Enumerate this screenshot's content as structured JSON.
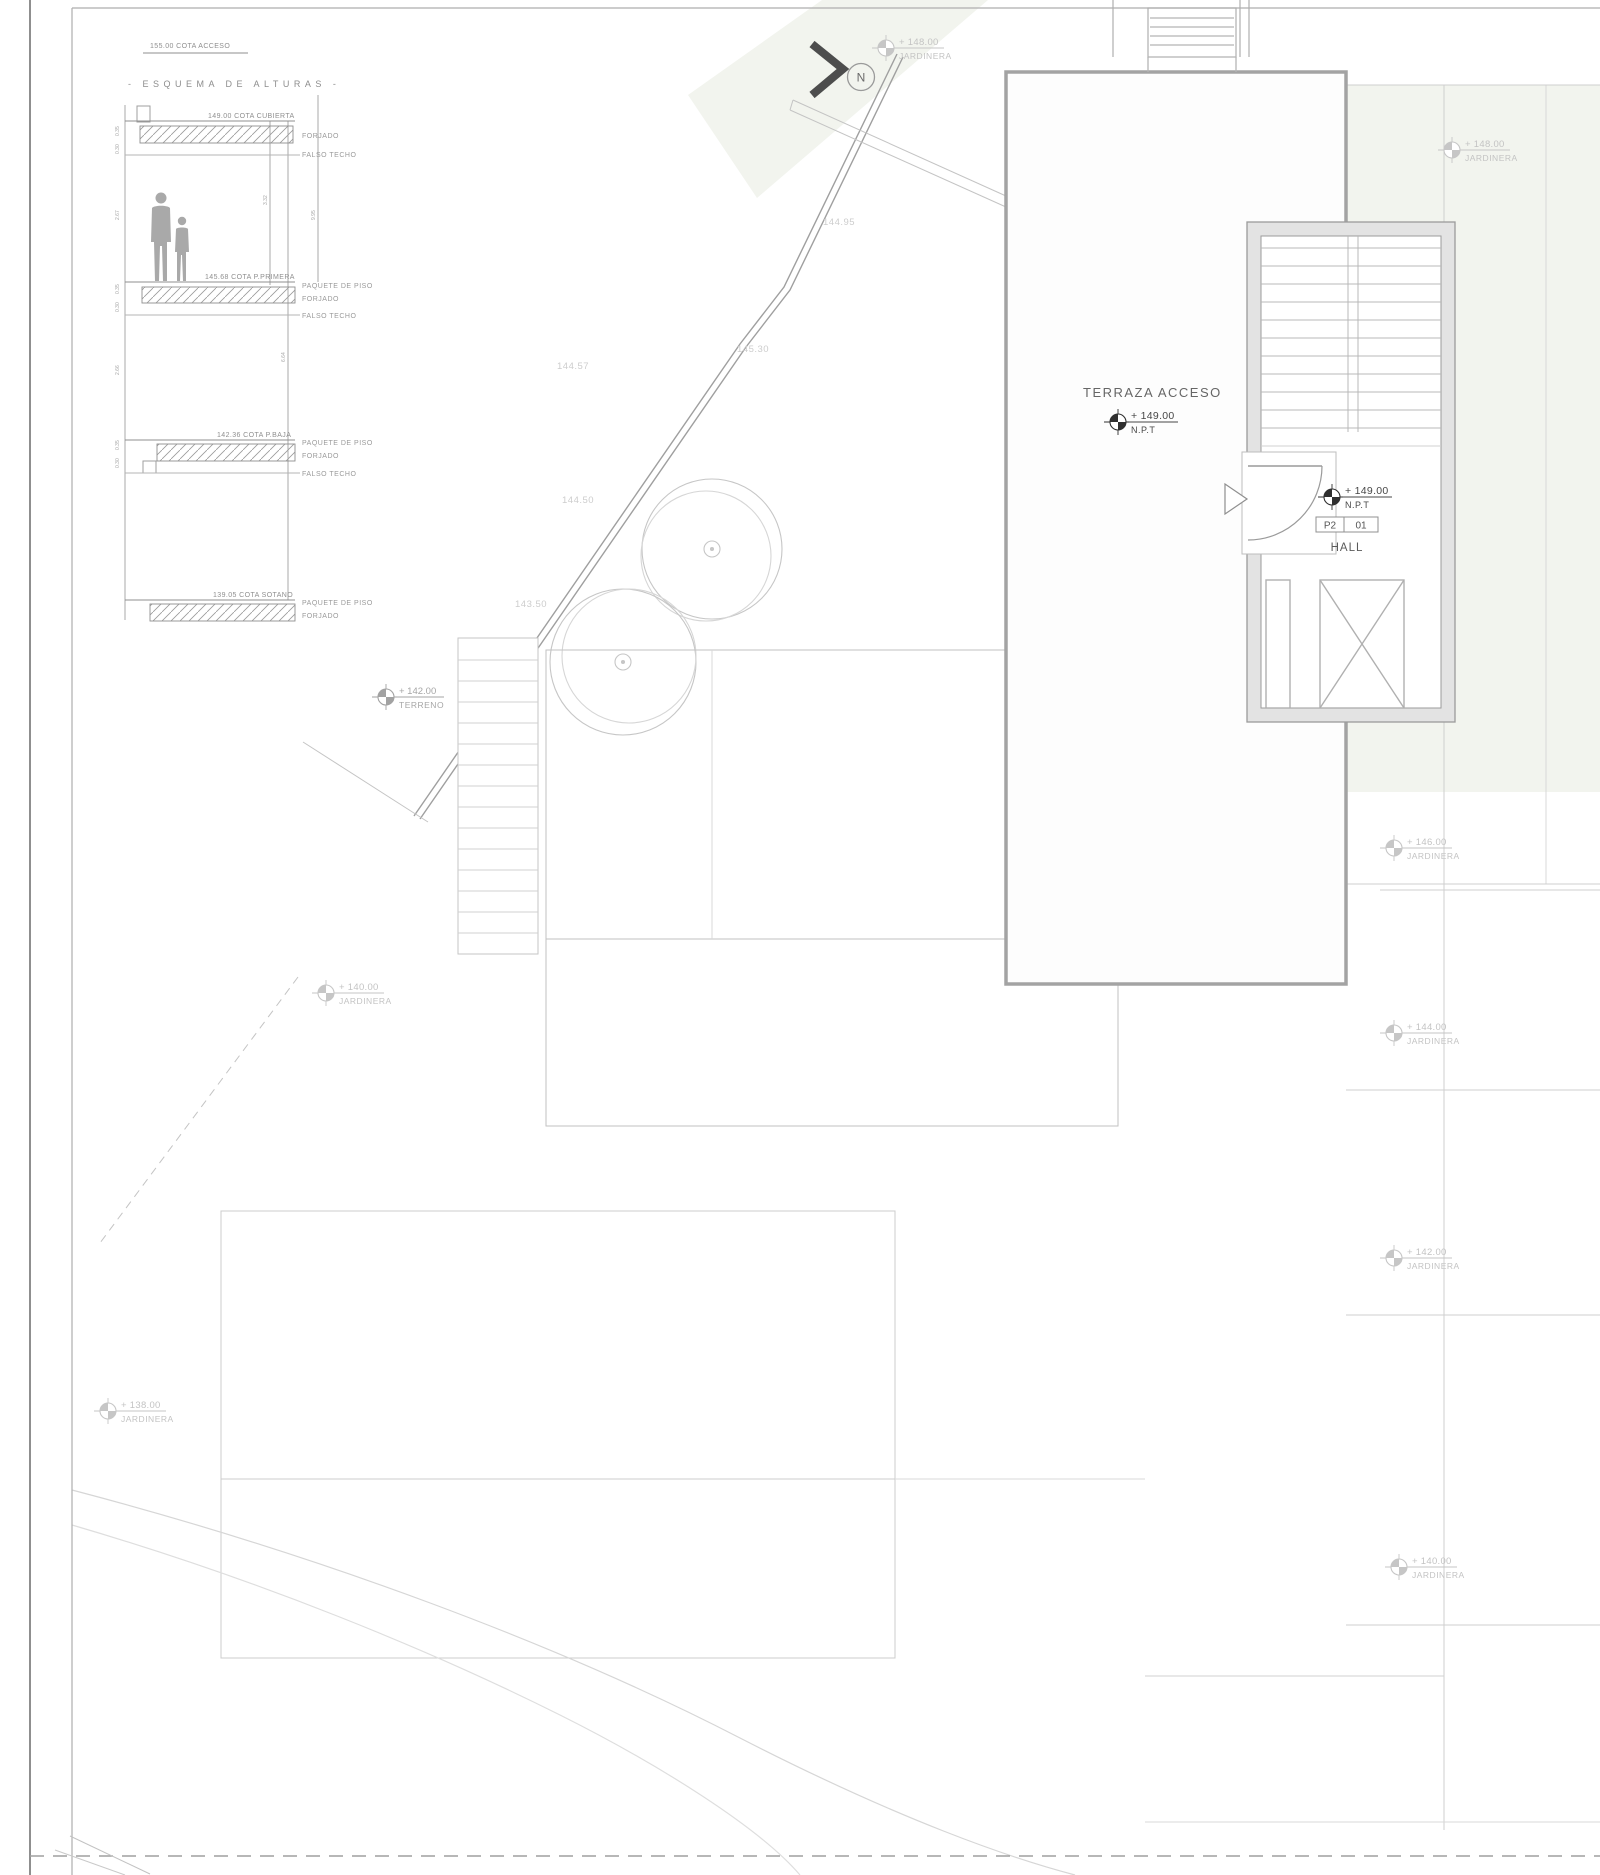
{
  "sheet": {
    "cota_acceso": "155.00 COTA ACCESO",
    "north_label": "N"
  },
  "esquema": {
    "title": "- ESQUEMA DE ALTURAS -",
    "levels": [
      {
        "cota": "149.00 COTA CUBIERTA",
        "tags": [
          "FORJADO",
          "FALSO TECHO"
        ]
      },
      {
        "cota": "145.68 COTA P.PRIMERA",
        "tags": [
          "PAQUETE DE PISO",
          "FORJADO",
          "FALSO TECHO"
        ]
      },
      {
        "cota": "142.36 COTA P.BAJA",
        "tags": [
          "PAQUETE DE PISO",
          "FORJADO",
          "FALSO TECHO"
        ]
      },
      {
        "cota": "139.05 COTA SOTANO",
        "tags": [
          "PAQUETE DE PISO",
          "FORJADO"
        ]
      }
    ],
    "dims_right": [
      "3.32",
      "6.64",
      "9.95"
    ],
    "dims_left": [
      "0.35",
      "0.30",
      "2.67",
      "0.35",
      "0.30",
      "2.66",
      "0.35",
      "0.30"
    ]
  },
  "plan": {
    "terraza_label": "TERRAZA ACCESO",
    "npt_markers": [
      {
        "value": "+ 149.00",
        "datum": "N.P.T"
      },
      {
        "value": "+ 149.00",
        "datum": "N.P.T"
      }
    ],
    "room_tag": {
      "zone": "P2",
      "number": "01",
      "name": "HALL"
    },
    "contours": [
      "144.95",
      "145.30",
      "144.57",
      "144.50",
      "143.50"
    ],
    "terreno_marker": {
      "value": "+ 142.00",
      "label": "TERRENO"
    },
    "jardineras": [
      {
        "value": "+ 148.00",
        "label": "JARDINERA"
      },
      {
        "value": "+ 148.00",
        "label": "JARDINERA"
      },
      {
        "value": "+ 146.00",
        "label": "JARDINERA"
      },
      {
        "value": "+ 144.00",
        "label": "JARDINERA"
      },
      {
        "value": "+ 142.00",
        "label": "JARDINERA"
      },
      {
        "value": "+ 140.00",
        "label": "JARDINERA"
      },
      {
        "value": "+ 140.00",
        "label": "JARDINERA"
      },
      {
        "value": "+ 138.00",
        "label": "JARDINERA"
      }
    ]
  },
  "colors": {
    "tint": "#f2f4ee",
    "line_light": "#c9c9c9",
    "line_mid": "#a3a3a3",
    "ink": "#4a4a4a",
    "marker_light": "#c6c6c6"
  }
}
